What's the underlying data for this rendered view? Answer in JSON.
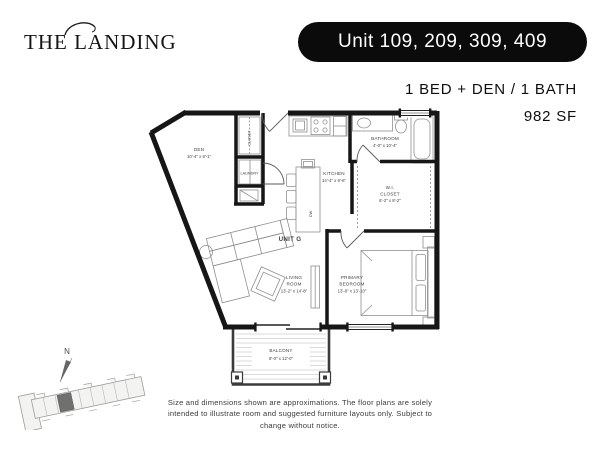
{
  "header": {
    "logo": "THE LANDING",
    "unit_banner": "Unit 109, 209, 309, 409",
    "spec_line": "1 BED + DEN / 1 BATH",
    "area_line": "982 SF"
  },
  "floorplan": {
    "unit_label": "UNIT G",
    "compass": "N",
    "rooms": {
      "den": {
        "name": "DEN",
        "dims": "10'-4\" x 8'-1\""
      },
      "closet": {
        "name": "CLOSET"
      },
      "laundry": {
        "name": "LAUNDRY"
      },
      "kitchen": {
        "name": "KITCHEN",
        "dims": "14'-4\" x 9'-6\""
      },
      "bathroom": {
        "name": "BATHROOM",
        "dims": "4'-0\" x 10'-4\""
      },
      "wi_closet": {
        "line1": "W.I.",
        "line2": "CLOSET",
        "dims": "6'-2\" x 8'-2\""
      },
      "living_room": {
        "line1": "LIVING",
        "line2": "ROOM",
        "dims": "13'-2\" x 14'-8\""
      },
      "primary_bedroom": {
        "line1": "PRIMARY",
        "line2": "BEDROOM",
        "dims": "13'-8\" x 13'-10\""
      },
      "balcony": {
        "name": "BALCONY",
        "dims": "8'-0\" x 12'-0\""
      }
    },
    "appliance_labels": {
      "dishwasher": "DW"
    }
  },
  "footer": {
    "disclaimer_lines": [
      "Size and dimensions shown are approximations. The floor plans are solely",
      "intended to illustrate room and suggested furniture layouts only. Subject to",
      "change without notice."
    ]
  },
  "colors": {
    "wall": "#161616",
    "banner_bg": "#0b0b0b",
    "banner_text": "#ffffff",
    "label_text": "#3e3e3e",
    "keyplan_highlight": "#707070"
  }
}
